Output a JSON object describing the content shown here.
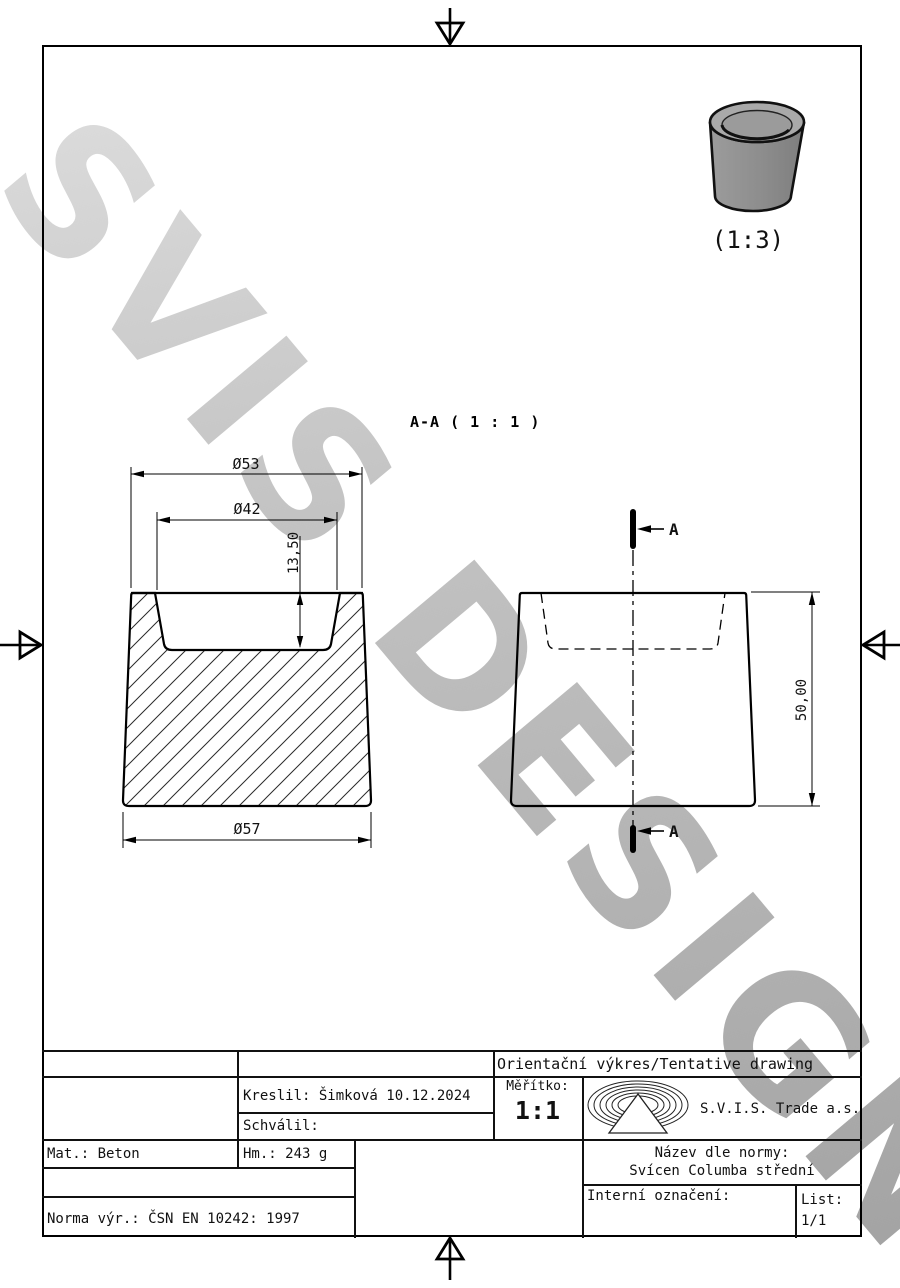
{
  "watermark": {
    "text": "SVIS DESIGN"
  },
  "views": {
    "section_label": "A-A ( 1 : 1 )",
    "section_arrow_label": "A",
    "thumbnail_scale": "(1:3)"
  },
  "dimensions": {
    "top_diameter": "Ø53",
    "recess_diameter": "Ø42",
    "recess_depth": "13,50",
    "base_diameter": "Ø57",
    "height": "50,00"
  },
  "colors": {
    "line": "#000000",
    "watermark": "#c3c3c3",
    "model_body": "#8d8d8d",
    "model_top": "#a9a9a9",
    "model_recess": "#9b9b9b"
  },
  "title_block": {
    "tentative": "Orientační výkres/Tentative drawing",
    "kreslil": "Kreslil: Šimková 10.12.2024",
    "schvalil": "Schválil:",
    "meritko_label": "Měřítko:",
    "meritko_value": "1:1",
    "company": "S.V.I.S. Trade a.s.",
    "mat": "Mat.: Beton",
    "hm": "Hm.: 243 g",
    "nazev_label": "Název dle normy:",
    "nazev_value": "Svícen Columba střední",
    "interni_label": "Interní označení:",
    "list_label": "List:",
    "list_value": "1/1",
    "norma": "Norma výr.: ČSN EN 10242: 1997"
  }
}
